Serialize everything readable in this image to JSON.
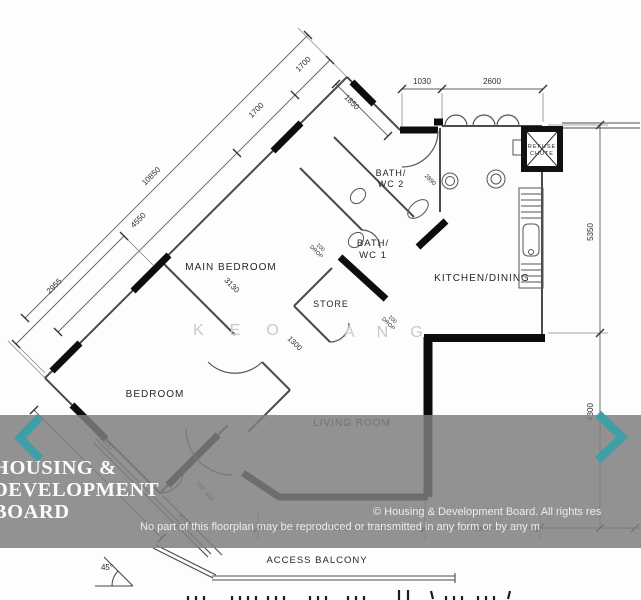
{
  "plan": {
    "rooms": {
      "main_bedroom": "MAIN BEDROOM",
      "bedroom": "BEDROOM",
      "living_room": "LIVING ROOM",
      "kitchen_dining": "KITCHEN/DINING",
      "store": "STORE",
      "bath1_line1": "BATH/",
      "bath1_line2": "WC 1",
      "bath2_line1": "BATH/",
      "bath2_line2": "WC 2",
      "access_balcony": "ACCESS BALCONY",
      "refuse_line1": "REFUSE",
      "refuse_line2": "CHUTE"
    },
    "dims": {
      "top_door": "1030",
      "top_kitchen": "2600",
      "right_upper": "5350",
      "right_lower": "4300",
      "chain_total": "10850",
      "chain_seg1": "4550",
      "chain_seg2": "1700",
      "chain_seg3": "1700",
      "bath_wall": "1850",
      "bedroom_edge": "2955",
      "main_bedroom_width": "3130",
      "bedroom_width": "4400",
      "store_width": "1300",
      "bath_inner": "2890",
      "bottom_left": "4450",
      "bottom_right": "3000",
      "drop_value": "100",
      "drop_word": "DROP",
      "step_a": "150",
      "step_b": "600",
      "balcony_len": "4100",
      "angle": "45°"
    }
  },
  "watermark": {
    "part1": "KEO",
    "part2": "ANG"
  },
  "overlay": {
    "brand_line1": "HOUSING &",
    "brand_line2": "DEVELOPMENT",
    "brand_line3": "BOARD",
    "copyright_line1": "© Housing & Development Board. All rights res",
    "copyright_line2": "No part of this floorplan may be reproduced or transmitted in any form or by any m",
    "band_color": "#7f7f7f",
    "chevron_color": "#3f9ea6"
  }
}
